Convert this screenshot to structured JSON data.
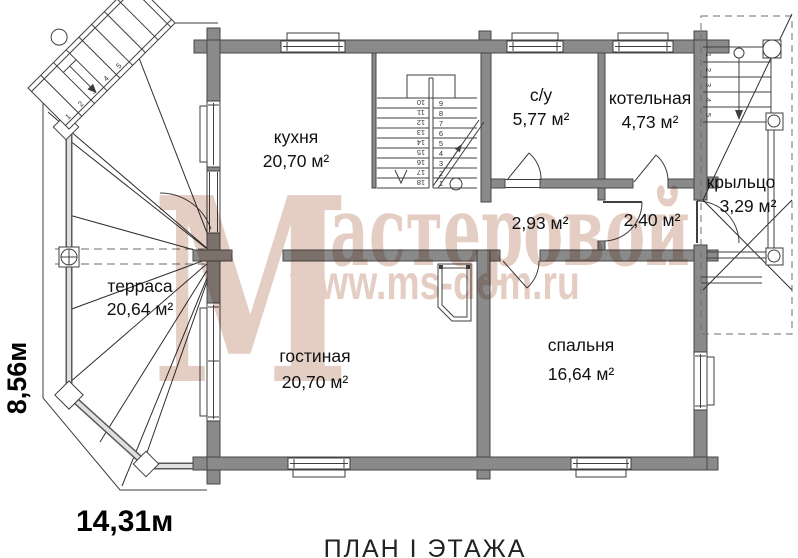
{
  "plan": {
    "title": "ПЛАН I ЭТАЖА",
    "width_label": "14,31м",
    "height_label": "8,56м"
  },
  "watermark": {
    "letter": "М",
    "word": "астеровой",
    "url": "www.ms-dom.ru"
  },
  "rooms": {
    "kitchen": {
      "name": "кухня",
      "area": "20,70 м²"
    },
    "living": {
      "name": "гостиная",
      "area": "20,70 м²"
    },
    "bedroom": {
      "name": "спальня",
      "area": "16,64 м²"
    },
    "wc": {
      "name": "с/у",
      "area": "5,77 м²"
    },
    "boiler": {
      "name": "котельная",
      "area": "4,73 м²"
    },
    "porch": {
      "name": "крыльцо",
      "area": "3,29 м²"
    },
    "terrace": {
      "name": "терраса",
      "area": "20,64 м²"
    },
    "hall_a": {
      "area": "2,93 м²"
    },
    "hall_b": {
      "area": "2,40 м²"
    }
  },
  "stairs": {
    "main_right": [
      "9",
      "8",
      "7",
      "6",
      "5",
      "4",
      "3",
      "2",
      "1"
    ],
    "main_left": [
      "10",
      "11",
      "12",
      "13",
      "14",
      "15",
      "16",
      "17",
      "18"
    ],
    "porch": [
      "1",
      "2",
      "3",
      "4",
      "5"
    ],
    "terrace": [
      "1",
      "2",
      "3",
      "4",
      "5"
    ]
  },
  "colors": {
    "wall": "#8a8a8a",
    "outline": "#3f3f3f",
    "watermark": "#c99d8a"
  }
}
